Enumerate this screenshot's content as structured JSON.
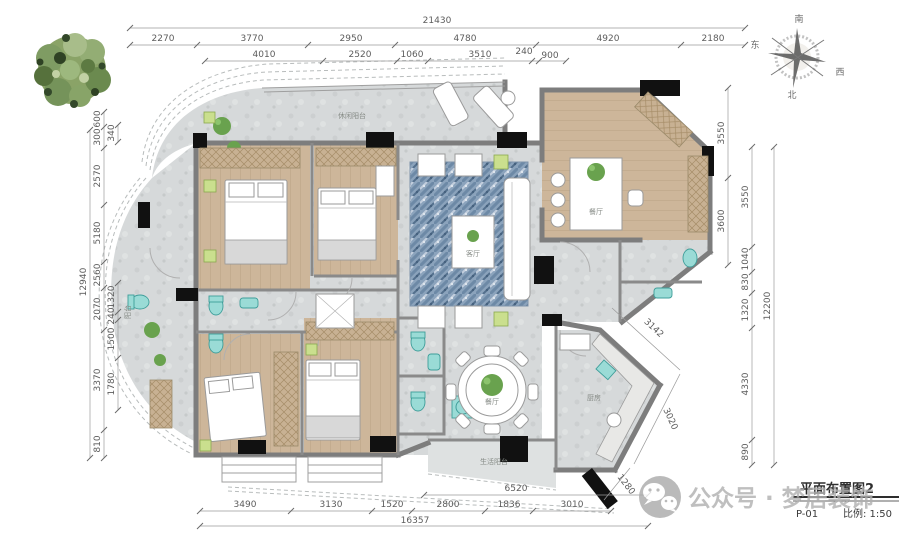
{
  "drawing": {
    "type": "apartment floor plan",
    "title_block": {
      "title": "平面布置图2",
      "sheet": "P-01",
      "scale": "比例: 1:50"
    },
    "watermark": {
      "text": "公众号 · 梦居装饰",
      "icon": "wechat-logo"
    },
    "compass": {
      "top": "南",
      "bottom": "北",
      "right": "西",
      "left": "东"
    },
    "rooms": {
      "terrace": "休闲阳台",
      "living": "客厅",
      "dining": "餐厅",
      "round_dining": "餐厅",
      "kitchen": "厨房",
      "service_balcony": "生活阳台",
      "side_balcony": "阳台"
    },
    "dimensions_mm": {
      "top": {
        "total": "21430",
        "row1": [
          "2270",
          "3770",
          "2950",
          "4780",
          "4920",
          "2180"
        ],
        "row2": [
          "4010",
          "2520",
          "1060",
          "3510",
          "240",
          "900"
        ]
      },
      "left": {
        "total": "12940",
        "outer": [
          "600",
          "300",
          "2570",
          "5180",
          "2560",
          "2070",
          "3370",
          "810"
        ],
        "inner": [
          "340",
          "1320",
          "240",
          "1500",
          "1780"
        ]
      },
      "right": {
        "total": "12200",
        "inner": [
          "3550",
          "3600"
        ],
        "outer": [
          "3550",
          "1040",
          "830",
          "1320",
          "4330",
          "890"
        ]
      },
      "bottom": {
        "total": "16357",
        "span": "6520",
        "row": [
          "3490",
          "3130",
          "1520",
          "2800",
          "1836",
          "3010"
        ]
      },
      "diagonal": [
        "3142",
        "3020",
        "1280"
      ]
    },
    "colors": {
      "wall": "#7d7d7d",
      "column": "#111111",
      "wood_floor": "#cdb69a",
      "tile_floor": "#d6d9da",
      "rug_blue": "#8ba3bc",
      "fixture_teal": "#9adbd6",
      "plant_green": "#69a24e",
      "dim_text": "#5c5c5c",
      "watermark_grey": "#b0b0b0"
    }
  }
}
